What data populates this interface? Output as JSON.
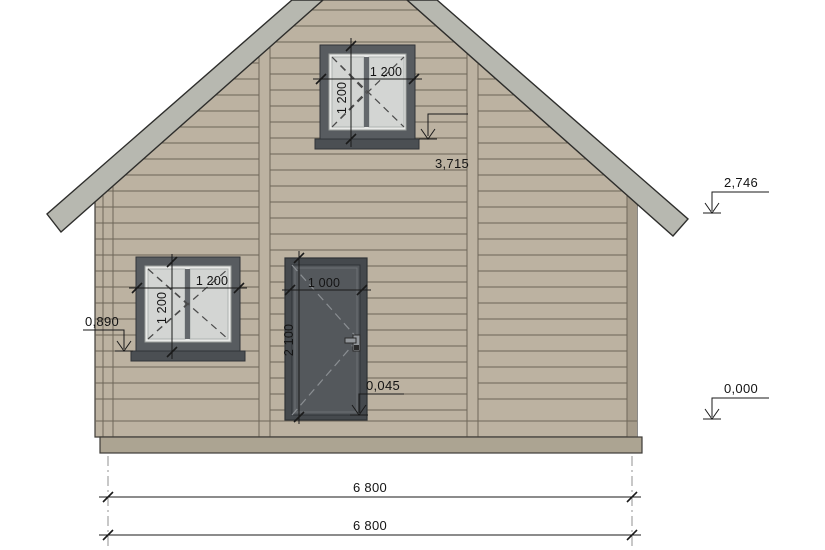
{
  "title": "house-front-elevation",
  "colors": {
    "background": "#ffffff",
    "wall": "#bcb2a1",
    "siding_line": "#5e574b",
    "trim_line": "#6e6759",
    "corner_shadow": "#a59b8a",
    "roof": "#b7b8b0",
    "plinth": "#aca492",
    "window_frame": "#585c60",
    "window_inner": "#e9eae8",
    "glass": "#d3d5d3",
    "mullion": "#64686c",
    "sill": "#4b4f53",
    "door_frame": "#45494d",
    "door_leaf": "#54585c",
    "handle": "#93979b",
    "dimension": "#1a1a1a"
  },
  "labels": {
    "upper_window_width": "1 200",
    "upper_window_height": "1 200",
    "lower_window_width": "1 200",
    "lower_window_height": "1 200",
    "door_width": "1 000",
    "door_height": "2 100",
    "total_width_upper": "6 800",
    "total_width_lower": "6 800"
  },
  "levels": {
    "upper_window_sill": "3,715",
    "eaves": "2,746",
    "lower_window_sill": "0,890",
    "door_threshold": "0,045",
    "ground": "0,000"
  }
}
